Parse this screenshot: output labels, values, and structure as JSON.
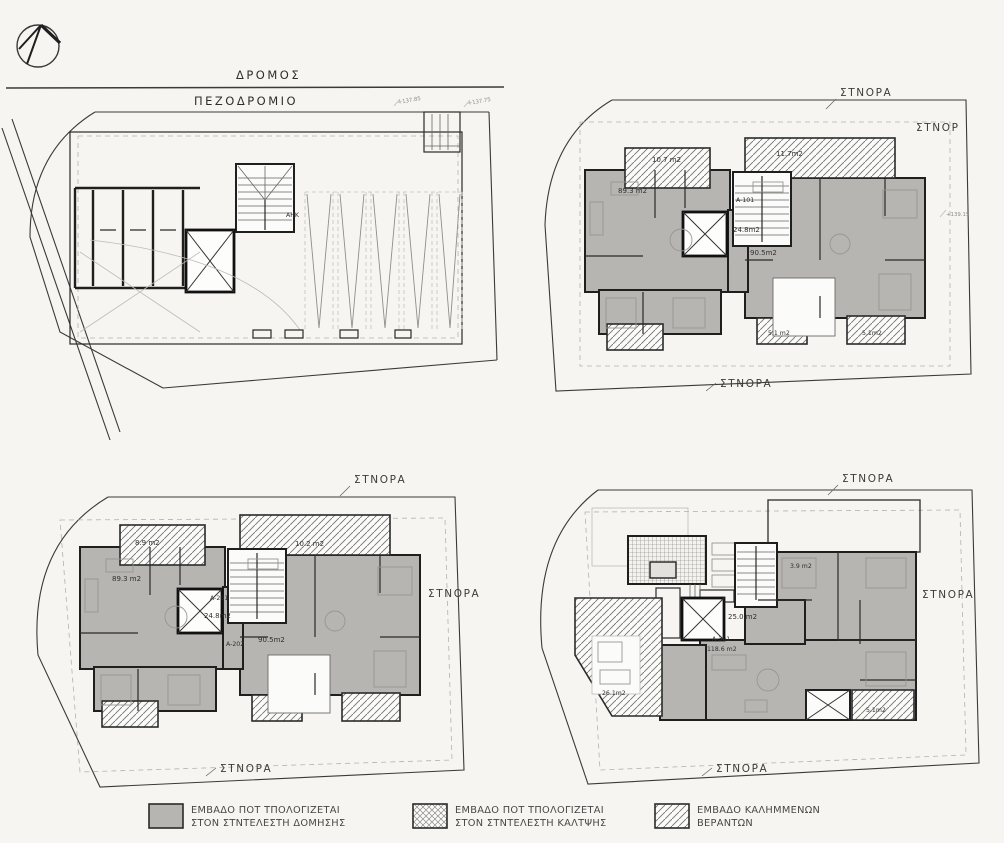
{
  "page": {
    "background": "#f6f5f1",
    "ink": "#1f1f1f",
    "area_fill_gray": "#b6b5b2"
  },
  "ground_floor": {
    "road_label": "ΔΡΟΜΟΣ",
    "sidewalk_label": "ΠΕΖΟΔΡΟΜΙΟ",
    "utility_room_label": "ΑΗΚ",
    "level_marks": [
      "+137.85",
      "+137.75"
    ]
  },
  "first_floor": {
    "boundary_top": "ΣΤΝΟΡΑ",
    "boundary_right": "ΣΤΝΟΡ",
    "boundary_bottom": "ΣΤΝΟΡΑ",
    "balcony_left_area": "10.7 m2",
    "balcony_right_area": "11.7m2",
    "apt_left_area": "89.3 m2",
    "apt_left_code": "A-101",
    "core_area": "24.8m2",
    "apt_right_area": "90.5m2",
    "veranda_left_area": "5.1 m2",
    "veranda_right_area": "5.1m2",
    "level_mark": "+139.15"
  },
  "second_floor": {
    "boundary_top": "ΣΤΝΟΡΑ",
    "boundary_right": "ΣΤΝΟΡΑ",
    "boundary_bottom": "ΣΤΝΟΡΑ",
    "balcony_left_area": "8.9 m2",
    "balcony_right_area": "10.2 m2",
    "apt_left_area": "89.3 m2",
    "apt_left_code": "A-201",
    "core_area": "24.8m2",
    "apt_right_code": "A-202",
    "apt_right_area": "90.5m2"
  },
  "third_floor": {
    "boundary_top": "ΣΤΝΟΡΑ",
    "boundary_right": "ΣΤΝΟΡΑ",
    "boundary_bottom": "ΣΤΝΟΡΑ",
    "balcony_top_area": "3.9 m2",
    "core_area": "25.0 m2",
    "apt_code": "A-301",
    "apt_area": "118.6 m2",
    "veranda_left_area": "26.1m2",
    "veranda_right_area": "5.1m2"
  },
  "legend": {
    "items": [
      {
        "swatch": "solid-gray",
        "line1": "ΕΜΒΑΔΟ ΠΟΤ ΤΠΟΛΟΓΙΖΕΤΑΙ",
        "line2": "ΣΤΟΝ ΣΤΝΤΕΛΕΣΤΗ ΔΟΜΗΣΗΣ"
      },
      {
        "swatch": "crosshatch",
        "line1": "ΕΜΒΑΔΟ ΠΟΤ ΤΠΟΛΟΓΙΖΕΤΑΙ",
        "line2": "ΣΤΟΝ ΣΤΝΤΕΛΕΣΤΗ ΚΑΛΤΨΗΣ"
      },
      {
        "swatch": "diagonal-hatch",
        "line1": "ΕΜΒΑΔΟ ΚΑΛΗΜΜΕΝΩΝ",
        "line2": "ΒΕΡΑΝΤΩΝ"
      }
    ]
  }
}
